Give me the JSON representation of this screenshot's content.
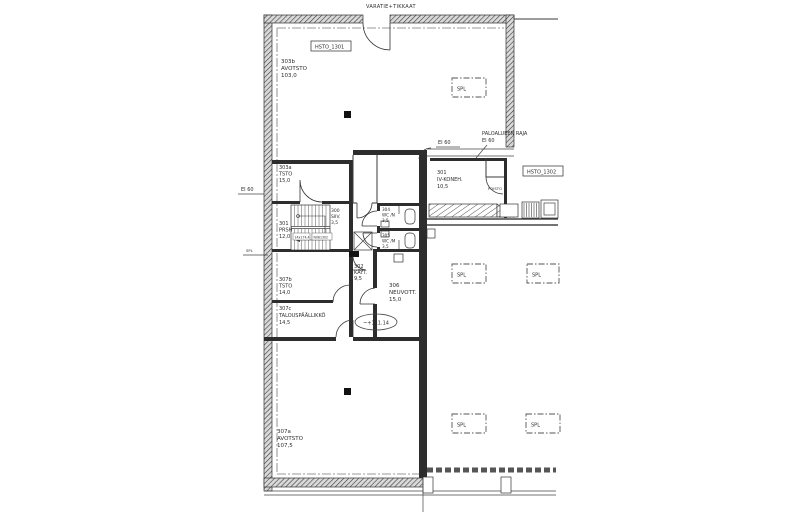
{
  "title": "VARATIE+TIKKAAT",
  "labels": {
    "tag_1301": "HSTO_1301",
    "tag_1302": "HSTO_1302",
    "spl": "SPL",
    "spl_wall": "SPL",
    "ei60_left": "EI 60",
    "ei60_mid": "EI 60",
    "fire_boundary_line1": "PALOALUEEN RAJA",
    "fire_boundary_line2": "EI 60",
    "poisto": "POISTO",
    "elevation": "~+111.14",
    "stair_note_left": "14x174,4",
    "stair_note_right": "N081302"
  },
  "rooms": [
    {
      "id": "303b",
      "name": "AVOTSTO",
      "area": "103,0"
    },
    {
      "id": "303a",
      "name": "TSTO",
      "area": "15,0"
    },
    {
      "id": "301",
      "name": "PRSH",
      "area": "12,0"
    },
    {
      "id": "300",
      "name": "SIIV.",
      "area": "3,5"
    },
    {
      "id": "304",
      "name": "WC /N",
      "area": "3,5"
    },
    {
      "id": "305",
      "name": "WC /M",
      "area": "3,5"
    },
    {
      "id": "301",
      "name": "IV-KONEH.",
      "area": "10,5"
    },
    {
      "id": "302",
      "name": "KÄYT.",
      "area": "9,5"
    },
    {
      "id": "306",
      "name": "NEUVOTT.",
      "area": "15,0"
    },
    {
      "id": "307b",
      "name": "TSTO",
      "area": "14,0"
    },
    {
      "id": "307c",
      "name": "TALOUSPÄÄLLIKKÖ",
      "area": "14,5"
    },
    {
      "id": "307a",
      "name": "AVOTSTO",
      "area": "107,5"
    }
  ]
}
